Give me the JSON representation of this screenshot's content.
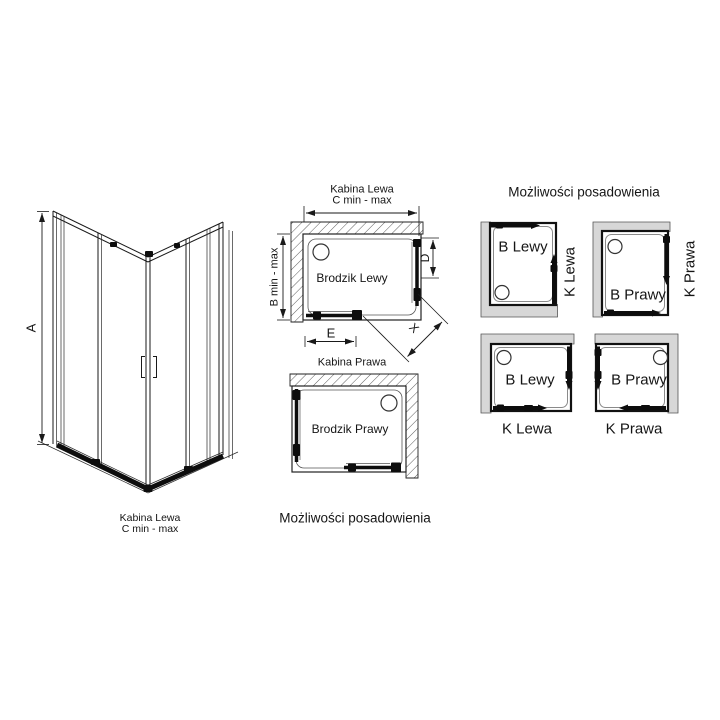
{
  "colors": {
    "background": "#ffffff",
    "line": "#1a1a1a",
    "wall_fill": "#d7d7d7"
  },
  "view_3d": {
    "dim_height": "A",
    "caption_title": "Kabina Lewa",
    "caption_range": "C min - max"
  },
  "plan_lewa": {
    "title": "Kabina Lewa",
    "width_range": "C min - max",
    "depth_range": "B min - max",
    "tray": "Brodzik Lewy",
    "door_width": "D",
    "dim_e": "E",
    "entry_width": "X"
  },
  "plan_prawa": {
    "title": "Kabina Prawa",
    "tray": "Brodzik Prawy"
  },
  "captions": {
    "placement_mid": "Możliwości posadowienia"
  },
  "placements": {
    "title": "Możliwości posadowienia",
    "items": [
      {
        "tray": "B Lewy",
        "cabin": "K Lewa",
        "label_position": "right"
      },
      {
        "tray": "B Prawy",
        "cabin": "K Prawa",
        "label_position": "right"
      },
      {
        "tray": "B Lewy",
        "cabin": "K Lewa",
        "label_position": "bottom"
      },
      {
        "tray": "B Prawy",
        "cabin": "K Prawa",
        "label_position": "bottom"
      }
    ]
  }
}
